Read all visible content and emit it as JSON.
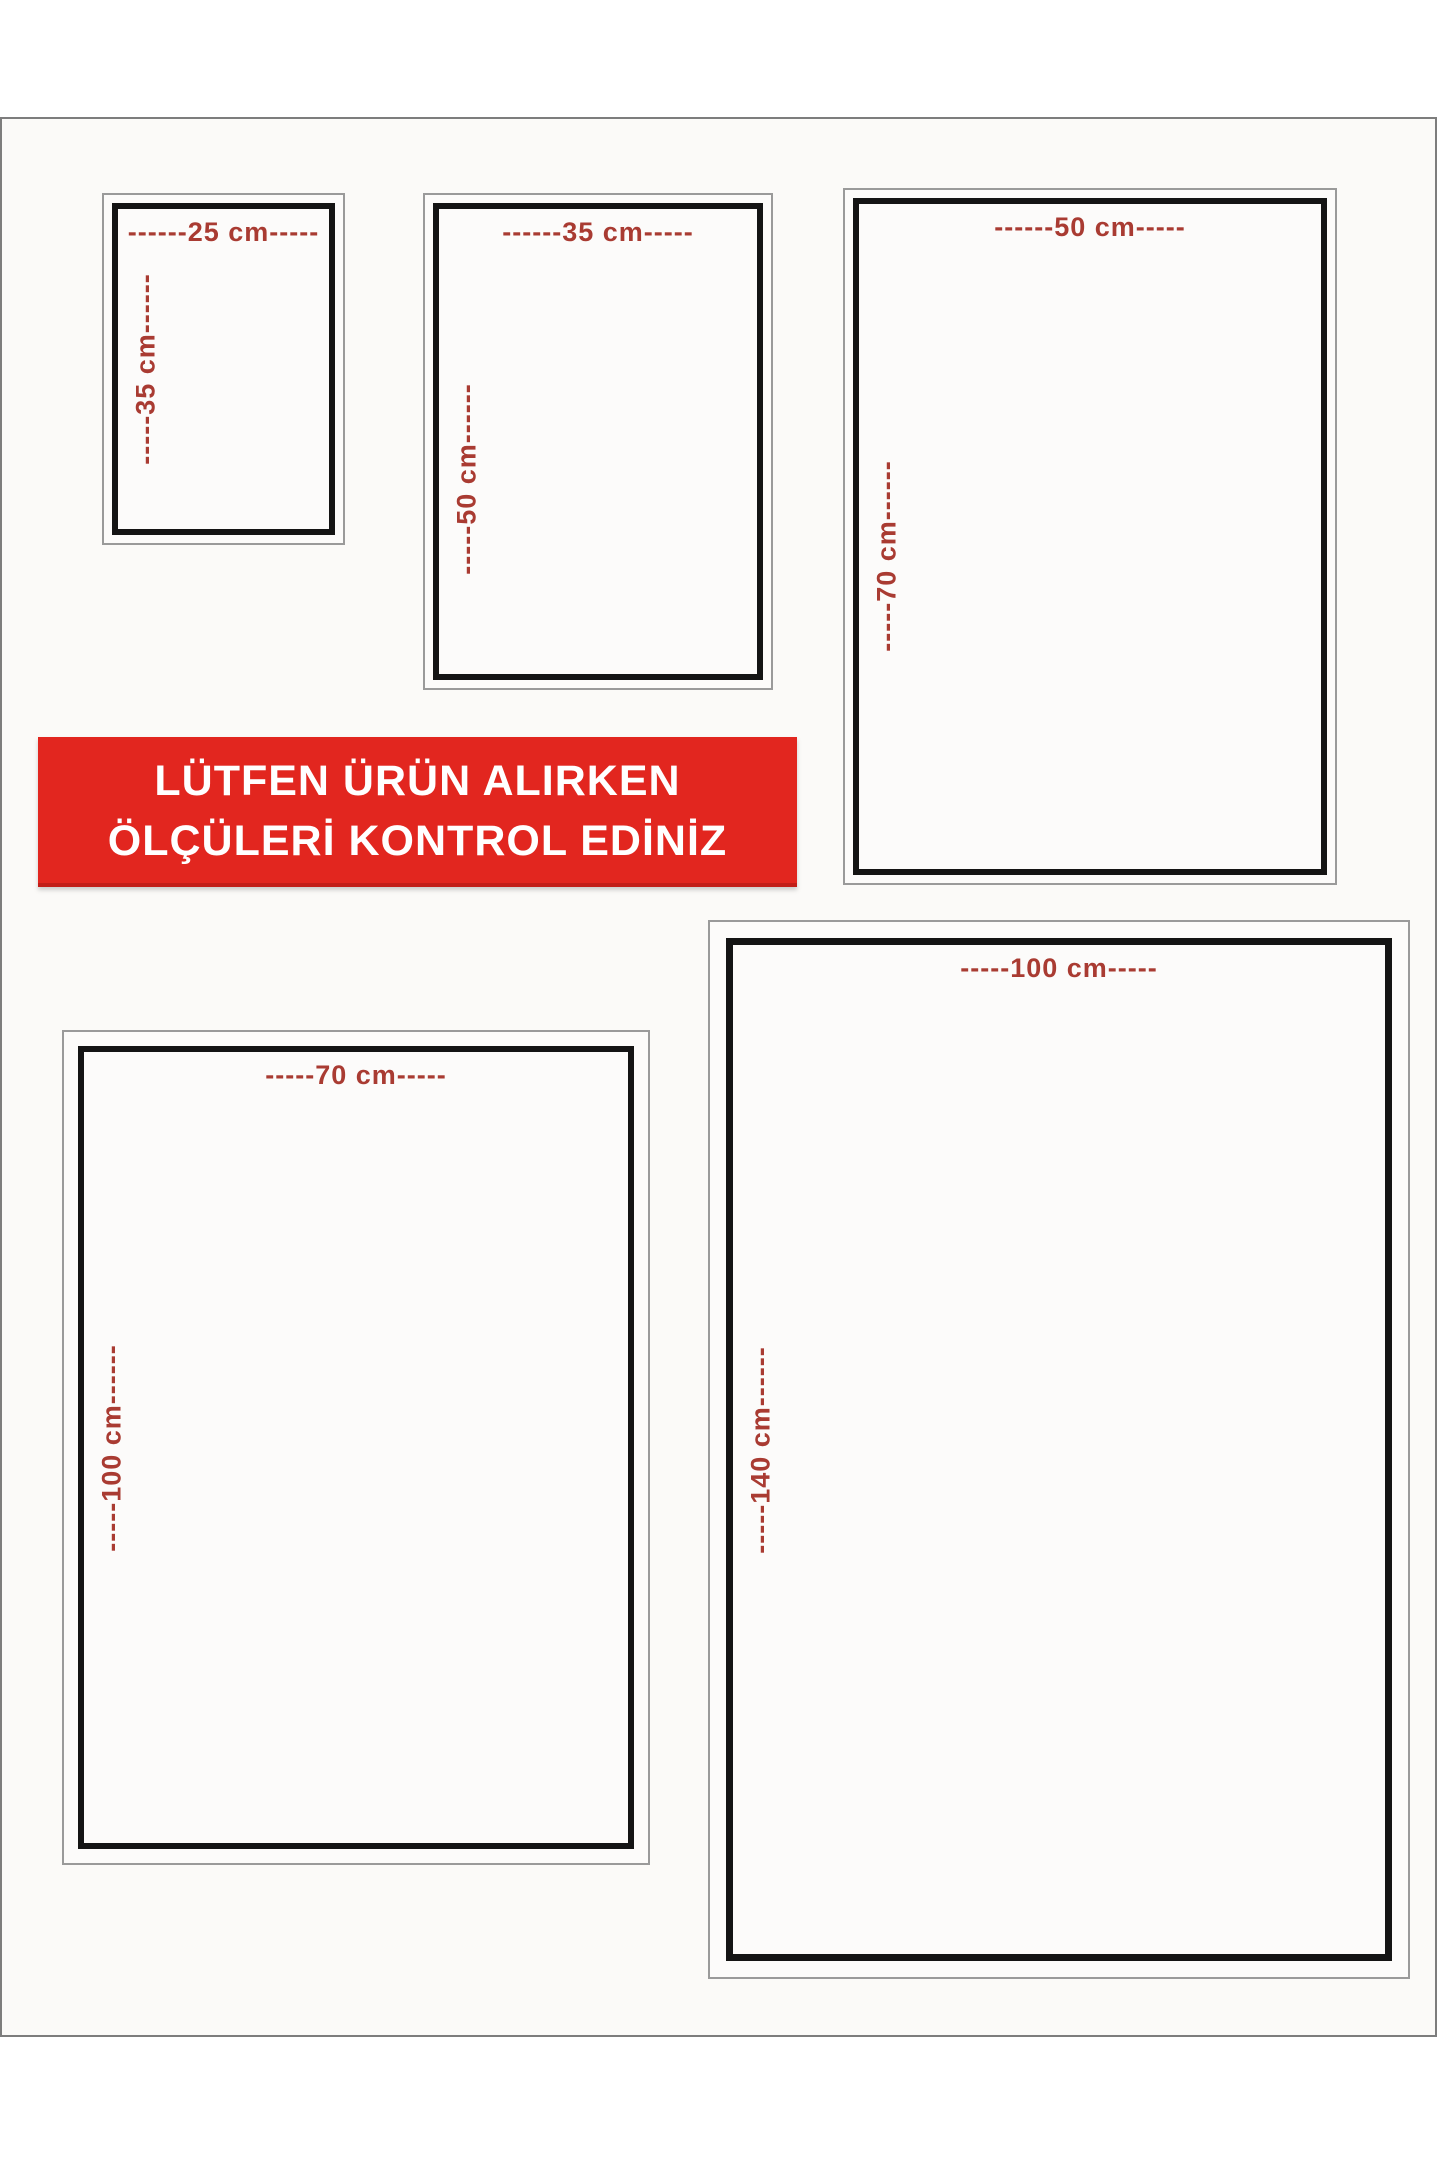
{
  "notice_banner": {
    "line1": "LÜTFEN ÜRÜN ALIRKEN",
    "line2": "ÖLÇÜLERİ KONTROL EDİNİZ",
    "background_color": "#e2261f",
    "text_color": "#ffffff"
  },
  "label_color": "#a93b32",
  "frame_border_color": "#141414",
  "size_boxes": [
    {
      "id": "25x35",
      "width_cm": 25,
      "height_cm": 35,
      "width_label": "------25 cm-----",
      "height_label": "-----35 cm------"
    },
    {
      "id": "35x50",
      "width_cm": 35,
      "height_cm": 50,
      "width_label": "------35 cm-----",
      "height_label": "-----50 cm------"
    },
    {
      "id": "50x70",
      "width_cm": 50,
      "height_cm": 70,
      "width_label": "------50 cm-----",
      "height_label": "-----70 cm------"
    },
    {
      "id": "70x100",
      "width_cm": 70,
      "height_cm": 100,
      "width_label": "-----70 cm-----",
      "height_label": "-----100 cm------"
    },
    {
      "id": "100x140",
      "width_cm": 100,
      "height_cm": 140,
      "width_label": "-----100 cm-----",
      "height_label": "-----140 cm------"
    }
  ]
}
